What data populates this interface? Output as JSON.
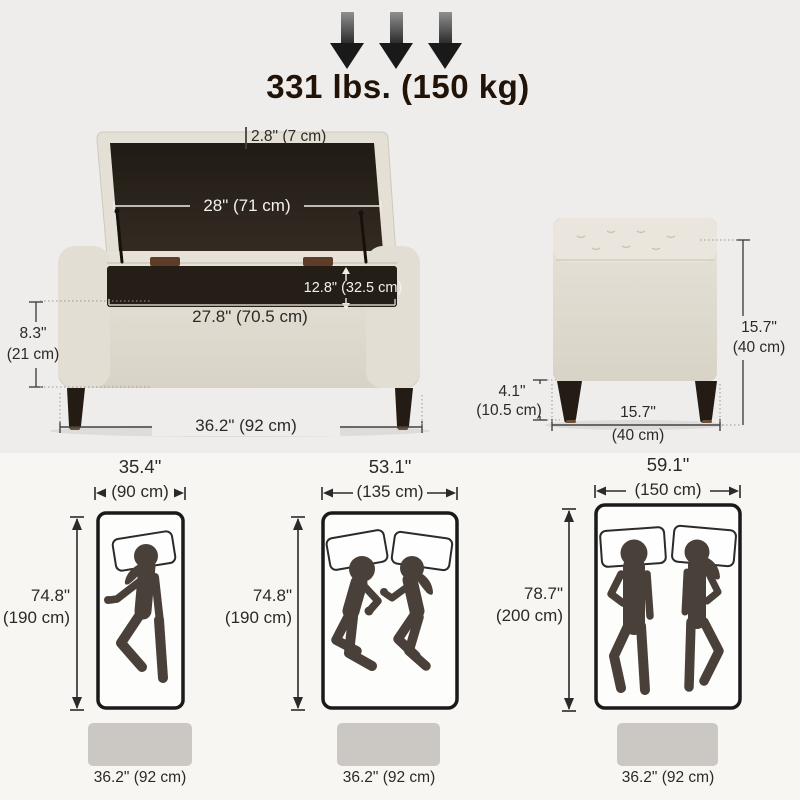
{
  "weight_limit": {
    "label": "331 lbs. (150 kg)",
    "arrow_count": 3
  },
  "ottoman_front_view": {
    "lid_thickness": "2.8\" (7 cm)",
    "lid_width": "28\" (71 cm)",
    "storage_depth": "12.8\" (32.5 cm)",
    "interior_width": "27.8\" (70.5 cm)",
    "seat_height_in": "8.3\"",
    "seat_height_cm": "(21 cm)",
    "overall_width": "36.2\" (92 cm)"
  },
  "ottoman_side_view": {
    "overall_height_in": "15.7\"",
    "overall_height_cm": "(40 cm)",
    "leg_height_in": "4.1\"",
    "leg_height_cm": "(10.5 cm)",
    "depth_in": "15.7\"",
    "depth_cm": "(40 cm)"
  },
  "mattress_comparison": [
    {
      "width_in": "35.4\"",
      "width_cm": "(90 cm)",
      "length_in": "74.8\"",
      "length_cm": "(190 cm)",
      "ottoman_width": "36.2\" (92 cm)",
      "sleepers": 1
    },
    {
      "width_in": "53.1\"",
      "width_cm": "(135 cm)",
      "length_in": "74.8\"",
      "length_cm": "(190 cm)",
      "ottoman_width": "36.2\" (92 cm)",
      "sleepers": 2
    },
    {
      "width_in": "59.1\"",
      "width_cm": "(150 cm)",
      "length_in": "78.7\"",
      "length_cm": "(200 cm)",
      "ottoman_width": "36.2\" (92 cm)",
      "sleepers": 2
    }
  ],
  "colors": {
    "fabric_beige": "#e0dbd0",
    "fabric_light": "#e9e5dc",
    "interior_dark": "#27211a",
    "leg_dark": "#241c14",
    "silhouette": "#4a403a",
    "dim_line": "#45423f",
    "ottoman_block_gray": "#cbc8c4",
    "bg_upper": "#eeedeb",
    "bg_lower": "#f7f6f3"
  }
}
